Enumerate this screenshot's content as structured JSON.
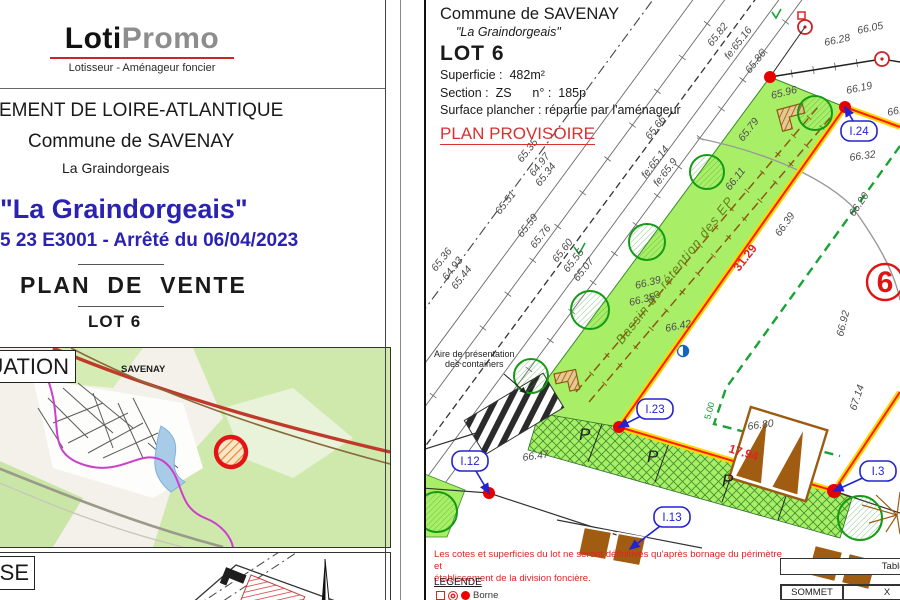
{
  "colors": {
    "accent_blue": "#2a22b0",
    "status_red": "#d93030",
    "lot_green": "#a9ee67",
    "boundary_yellow": "#ffd800",
    "boundary_red": "#ff1a1a",
    "dash_green": "#18a335",
    "brown": "#9a5c10"
  },
  "left_page": {
    "logo": {
      "brand_black": "Loti",
      "brand_gray": "Promo",
      "tagline": "Lotisseur - Aménageur foncier"
    },
    "department_line": "RTEMENT DE LOIRE-ATLANTIQUE",
    "commune_line": "Commune de SAVENAY",
    "place_line": "La Graindorgeais",
    "title": "\"La Graindorgeais\"",
    "reference": "5 23 E3001 - Arrêté du 06/04/2023",
    "doc_type": "PLAN  DE  VENTE",
    "lot": "LOT 6",
    "situation_label": "TUATION",
    "map_town": "SAVENAY",
    "masse_label": "SE"
  },
  "right_page": {
    "commune": "Commune de SAVENAY",
    "place": "\"La Graindorgeais\"",
    "lot_title": "LOT 6",
    "superficie": "Superficie :  482m²",
    "section": "Section :  ZS      n° :  185p",
    "surface_plancher": "Surface plancher : répartie par l'aménageur",
    "status": "PLAN PROVISOIRE",
    "lot_number": "6",
    "basin_label": "Bassin de rétention des EP",
    "containers_label_1": "Aire de présentation",
    "containers_label_2": "des containers",
    "note_line1": "Les cotes et superficies du lot ne seront définitives qu'après bornage du périmètre et",
    "note_line2": "établissement de la division foncière.",
    "legend_title": "LEGENDE",
    "legend_borne": "Borne",
    "table_title": "Tableau d",
    "table_headers": [
      "SOMMET",
      "X"
    ],
    "table_row": [
      "I.2",
      "13289"
    ],
    "parking_letter": "P",
    "parking_positions": [
      {
        "x": 153,
        "y": 440
      },
      {
        "x": 221,
        "y": 462
      },
      {
        "x": 296,
        "y": 486
      }
    ],
    "measurements": [
      {
        "t": "65.35",
        "x": 96,
        "y": 163,
        "r": -52
      },
      {
        "t": "64.97",
        "x": 108,
        "y": 177,
        "r": -52
      },
      {
        "t": "65.34",
        "x": 114,
        "y": 187,
        "r": -52
      },
      {
        "t": "65.51",
        "x": 74,
        "y": 215,
        "r": -52
      },
      {
        "t": "65.59",
        "x": 96,
        "y": 238,
        "r": -52
      },
      {
        "t": "65.76",
        "x": 109,
        "y": 249,
        "r": -52
      },
      {
        "t": "65.36",
        "x": 10,
        "y": 272,
        "r": -52
      },
      {
        "t": "64.93",
        "x": 21,
        "y": 281,
        "r": -52
      },
      {
        "t": "65.44",
        "x": 30,
        "y": 290,
        "r": -52
      },
      {
        "t": "65.60",
        "x": 131,
        "y": 263,
        "r": -52
      },
      {
        "t": "65.55",
        "x": 142,
        "y": 273,
        "r": -52
      },
      {
        "t": "65.07",
        "x": 152,
        "y": 282,
        "r": -52
      },
      {
        "t": "65.66",
        "x": 224,
        "y": 140,
        "r": -52
      },
      {
        "t": "fe:65.14",
        "x": 220,
        "y": 179,
        "r": -52
      },
      {
        "t": "65.82",
        "x": 286,
        "y": 47,
        "r": -52
      },
      {
        "t": "fe:65.16",
        "x": 303,
        "y": 60,
        "r": -52
      },
      {
        "t": "65.86",
        "x": 324,
        "y": 74,
        "r": -52
      },
      {
        "t": "65.96",
        "x": 346,
        "y": 99,
        "r": -14
      },
      {
        "t": "65.79",
        "x": 317,
        "y": 142,
        "r": -52
      },
      {
        "t": "fe:65.9",
        "x": 232,
        "y": 187,
        "r": -52
      },
      {
        "t": "66.11",
        "x": 304,
        "y": 191,
        "r": -52
      },
      {
        "t": "66.39",
        "x": 210,
        "y": 289,
        "r": -14
      },
      {
        "t": "66.35",
        "x": 204,
        "y": 306,
        "r": -14
      },
      {
        "t": "66.42",
        "x": 240,
        "y": 332,
        "r": -12
      },
      {
        "t": "66.19",
        "x": 421,
        "y": 94,
        "r": -12
      },
      {
        "t": "66.05",
        "x": 432,
        "y": 34,
        "r": -12
      },
      {
        "t": "66.28",
        "x": 399,
        "y": 46,
        "r": -12
      },
      {
        "t": "66.33",
        "x": 462,
        "y": 116,
        "r": -12
      },
      {
        "t": "66.32",
        "x": 424,
        "y": 161,
        "r": -8
      },
      {
        "t": "66.20",
        "x": 428,
        "y": 217,
        "r": -55
      },
      {
        "t": "66.39",
        "x": 354,
        "y": 237,
        "r": -55
      },
      {
        "t": "66.92",
        "x": 417,
        "y": 337,
        "r": -76
      },
      {
        "t": "67.14",
        "x": 430,
        "y": 411,
        "r": -72
      },
      {
        "t": "66.80",
        "x": 322,
        "y": 430,
        "r": -8
      },
      {
        "t": "66.47",
        "x": 97,
        "y": 461,
        "r": -8
      }
    ],
    "red_dims": [
      {
        "t": "31.29",
        "x": 313,
        "y": 272,
        "r": -52
      },
      {
        "t": "17.94",
        "x": 302,
        "y": 452,
        "r": 17
      }
    ],
    "green_dims": [
      {
        "t": "5.00",
        "x": 284,
        "y": 420,
        "r": -75
      }
    ],
    "vertex_labels": [
      {
        "t": "I.24",
        "bx": 433,
        "by": 131,
        "dx": 419,
        "dy": 107
      },
      {
        "t": "I.23",
        "bx": 229,
        "by": 409,
        "dx": 193,
        "dy": 427
      },
      {
        "t": "I.12",
        "bx": 44,
        "by": 461,
        "dx": 63,
        "dy": 493
      },
      {
        "t": "I.13",
        "bx": 246,
        "by": 517,
        "dx": 204,
        "dy": 549
      },
      {
        "t": "I.3",
        "bx": 452,
        "by": 471,
        "dx": 408,
        "dy": 491
      }
    ]
  }
}
